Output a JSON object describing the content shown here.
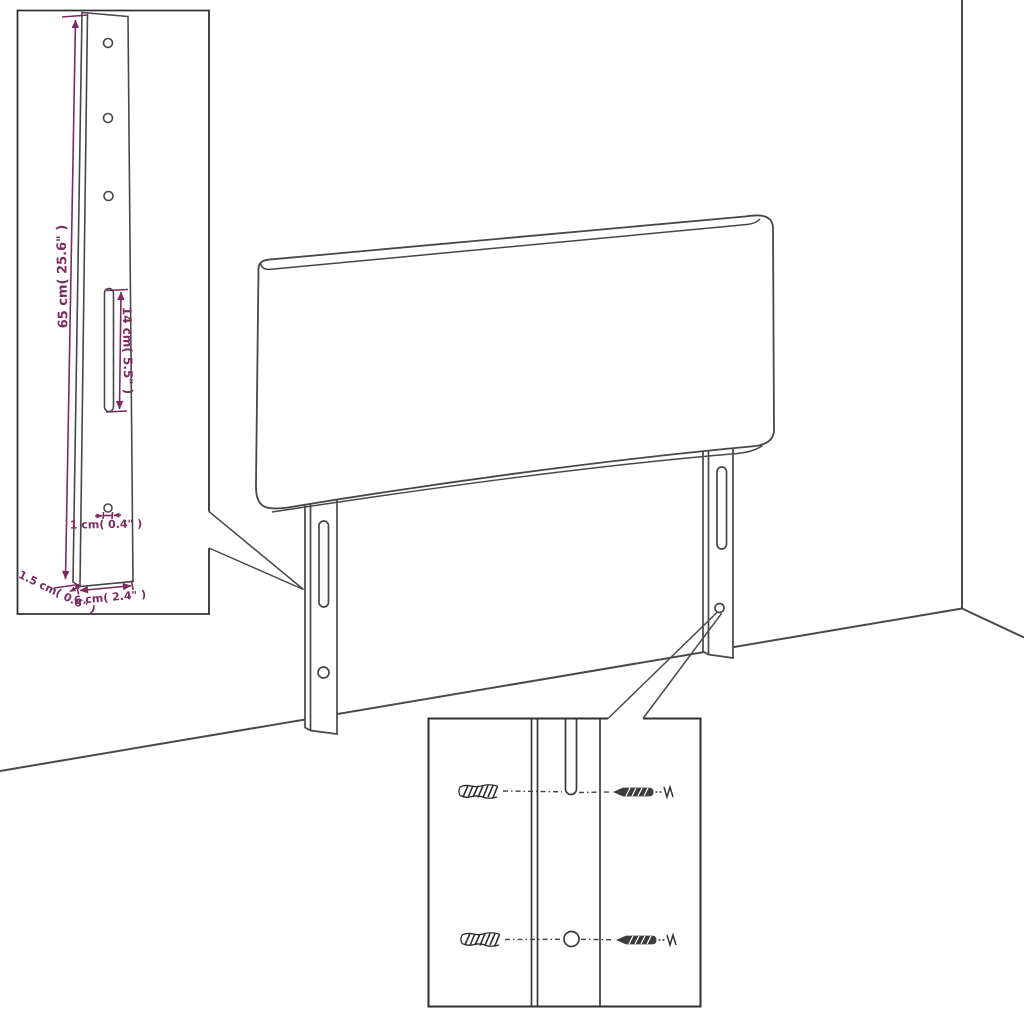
{
  "scene": {
    "background_color": "#ffffff",
    "line_color": "#474747",
    "inset_border_color": "#303030",
    "dimension_color": "#7c2a62"
  },
  "bracket_detail_inset": {
    "height_label": "65 cm( 25.6\" )",
    "slot_length_label": "14 cm( 5.5\" )",
    "hole_diameter_label": "1 cm( 0.4\" )",
    "thickness_label": "1.5 cm( 0.6\" )",
    "width_label": "6 cm( 2.4\" )",
    "mount_hole_count": 3
  },
  "headboard": {
    "leg_count": 2,
    "slots_per_leg": 1,
    "holes_per_leg": 1
  },
  "mounting_detail_inset": {
    "wall_plug_icon_count": 2,
    "screw_icon_count": 2
  }
}
